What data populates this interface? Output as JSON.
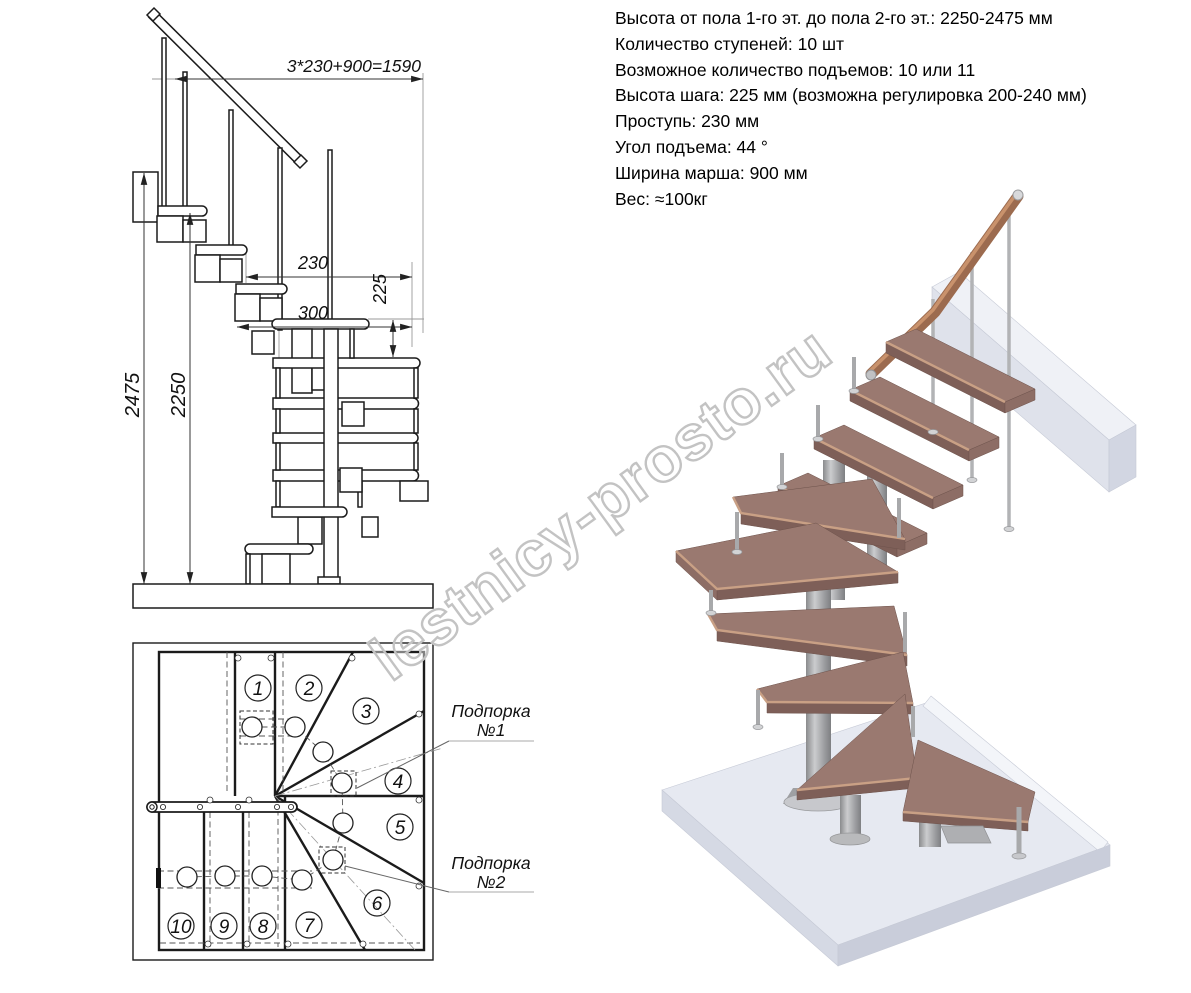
{
  "specs": {
    "lines": [
      "Высота от пола 1-го эт. до пола 2-го эт.: 2250-2475 мм",
      "Количество ступеней: 10 шт",
      "Возможное количество подъемов: 10 или 11",
      "Высота шага: 225 мм (возможна регулировка 200-240 мм)",
      "Проступь: 230 мм",
      "Угол подъема: 44 °",
      "Ширина марша: 900 мм",
      "Вес: ≈100кг"
    ]
  },
  "side_view": {
    "dims": {
      "total": "3*230+900=1590",
      "tread": "230",
      "depth": "300",
      "riser": "225",
      "height_max": "2475",
      "height_min": "2250"
    }
  },
  "plan_view": {
    "steps": [
      "1",
      "2",
      "3",
      "4",
      "5",
      "6",
      "7",
      "8",
      "9",
      "10"
    ],
    "support1": {
      "line1": "Подпорка",
      "line2": "№1"
    },
    "support2": {
      "line1": "Подпорка",
      "line2": "№2"
    }
  },
  "watermark": {
    "text": "lestnicy-prosto.ru"
  },
  "colors": {
    "wood_top": "#9a7970",
    "wood_edge": "#c9a085",
    "wood_side": "#7e5f58",
    "metal": "#b2b3b5",
    "floor_top": "#e6e9f1",
    "line": "#1b1b1b"
  }
}
